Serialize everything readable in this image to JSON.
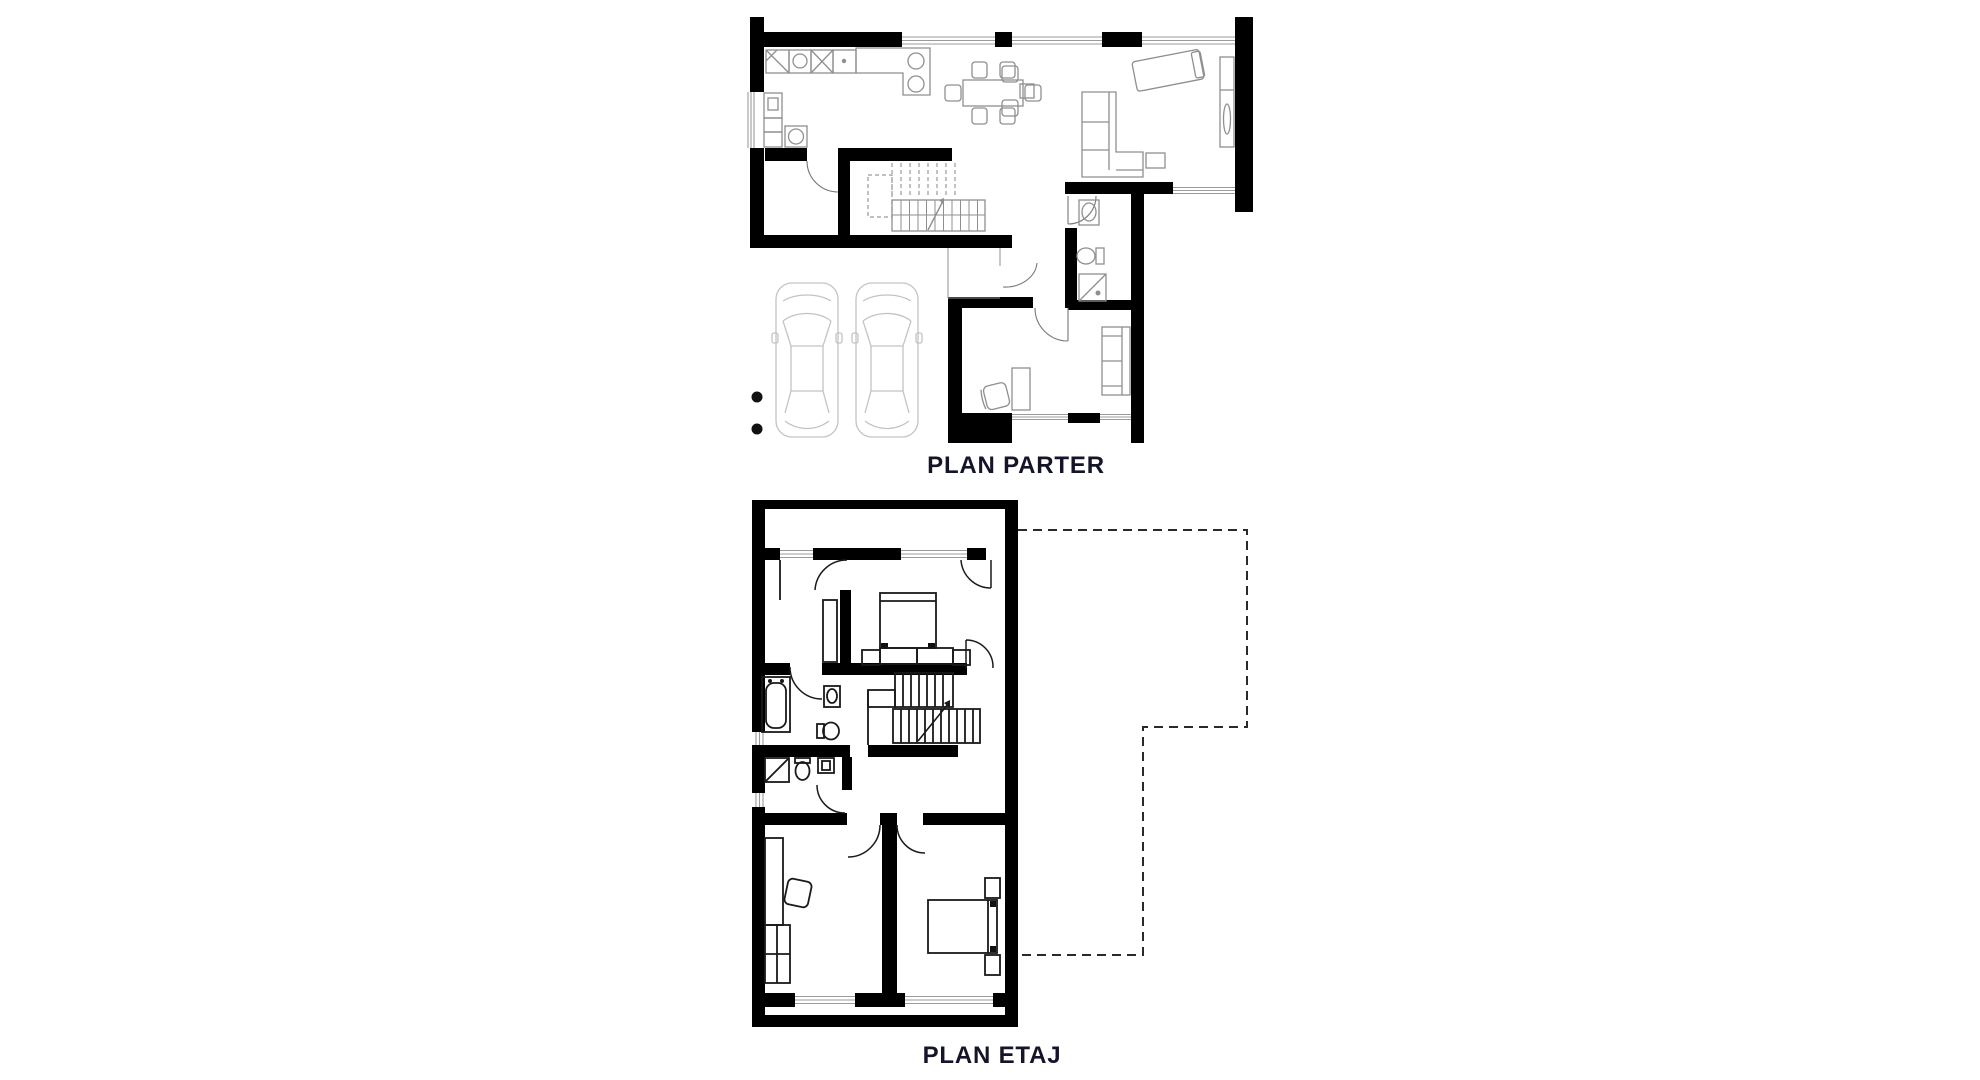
{
  "title_labels": {
    "parter": "PLAN PARTER",
    "etaj": "PLAN ETAJ"
  },
  "colors": {
    "background": "#ffffff",
    "wall": "#000000",
    "parter_furniture_line": "#8f8f8f",
    "etaj_furniture_line": "#1a1a1a",
    "window_line": "#9b9b9b",
    "car_line": "#c3c3c3",
    "dashed_footprint_outline": "#2a2a2a",
    "label_text": "#15152a"
  },
  "plans": [
    {
      "id": "parter",
      "label": "PLAN PARTER",
      "rooms": [
        "kitchen",
        "dining",
        "living",
        "pantry",
        "stairs",
        "hall",
        "bathroom",
        "office",
        "carport"
      ],
      "icons": [
        "kitchen-counter-icon",
        "sink-icon",
        "cooktop-icon",
        "dining-table-icon",
        "chair-icon",
        "daybed-icon",
        "sofa-icon",
        "shelf-icon",
        "stairs-icon",
        "toilet-icon",
        "shower-icon",
        "desk-icon",
        "office-chair-icon",
        "car-icon",
        "car-icon",
        "column-dot-icon",
        "column-dot-icon"
      ]
    },
    {
      "id": "etaj",
      "label": "PLAN ETAJ",
      "rooms": [
        "balcony",
        "dressing",
        "master-bedroom",
        "bathroom",
        "wc",
        "stairs",
        "hall",
        "bedroom-left",
        "bedroom-right"
      ],
      "icons": [
        "bed-icon",
        "nightstand-icon",
        "bathtub-icon",
        "sink-icon",
        "toilet-icon",
        "shower-icon",
        "stairs-icon",
        "desk-icon",
        "chair-icon",
        "wardrobe-icon",
        "dashed-footprint-outline"
      ]
    }
  ]
}
